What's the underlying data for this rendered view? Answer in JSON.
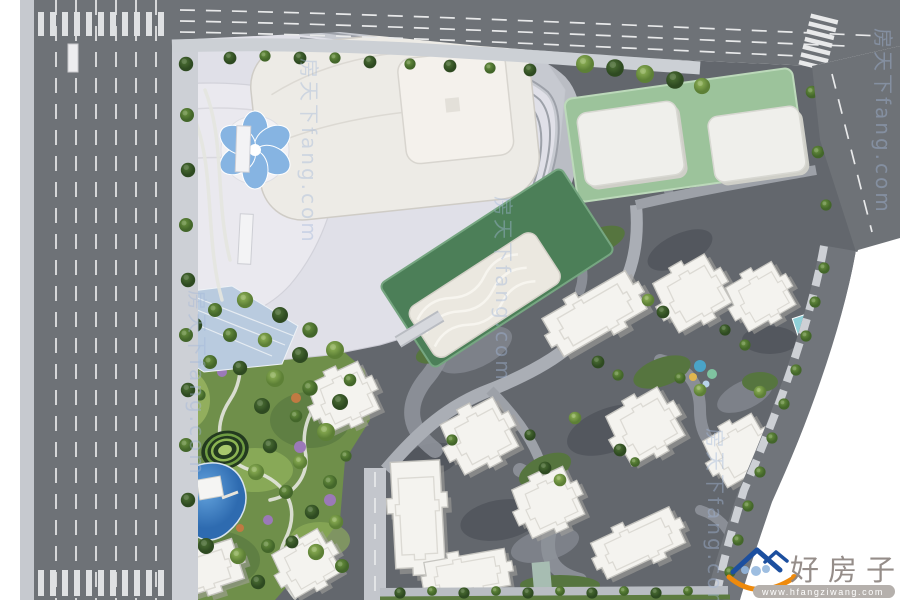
{
  "meta": {
    "description": "Aerial bird's-eye master plan rendering of a mixed-use development: shopping mall podium, green-roof retail blocks, central landscaped park with lake, and residential towers surrounded by city roads"
  },
  "watermarks": {
    "corner": {
      "site_name": "好房子网",
      "url": "www.hfangziwang.com"
    },
    "diagonal": {
      "text": "房天下fang.com",
      "repetitions": 5
    }
  },
  "palette": {
    "road": "#6e7277",
    "sidewalk": "#c9ccd2",
    "ground_residential": "#63676d",
    "mall_podium": "#e0e0e8",
    "mall_roof": "#edebe6",
    "green_roof_podium": "#9cc39b",
    "green_platform": "#4c7f58",
    "park_base": "#6f8f4a",
    "water": "#4b8ed2",
    "tower_roof": "#f4f3ef",
    "tree_dark": "#3c5a2e",
    "tree_mid": "#55793a",
    "tree_light": "#76a04b",
    "watermark_blue": "#a3b8da",
    "logo_blue": "#1c4f9f",
    "logo_orange": "#ee8a0c",
    "corner_text": "#8d8480"
  }
}
